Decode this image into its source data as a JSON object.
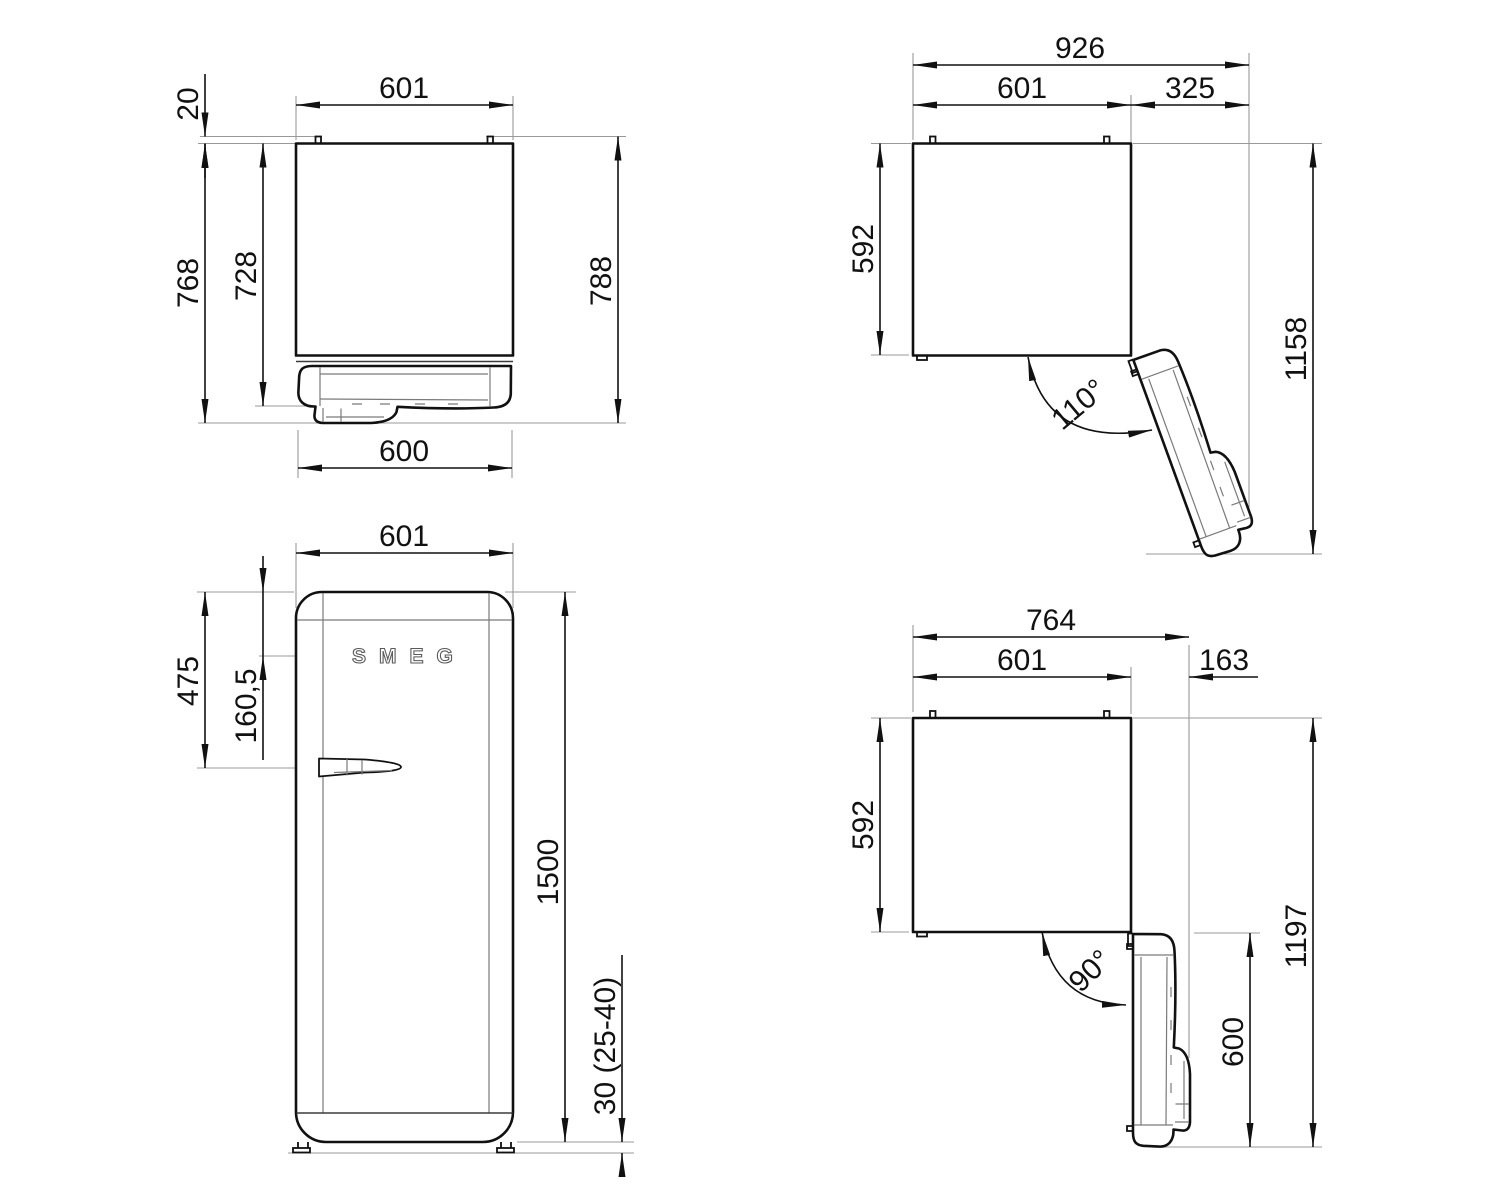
{
  "drawing": {
    "type": "appliance-installation-dimension-drawing",
    "units_note": "mm",
    "colors": {
      "line": "#111111",
      "detail": "#7a7a7a",
      "extension": "#999999",
      "background": "#ffffff"
    },
    "views": {
      "plan_closed": {
        "body_width": "601",
        "hinge_pin_offset": "20",
        "depth_with_door": "728",
        "depth_with_handle": "768",
        "depth_total": "788",
        "door_width": "600"
      },
      "plan_open_110": {
        "overall_width": "926",
        "body_width": "601",
        "door_clearance": "325",
        "body_depth": "592",
        "depth_door_open": "1158",
        "opening_angle": "110°"
      },
      "front": {
        "body_width": "601",
        "handle_offset_top": "475",
        "logo_offset_top": "160,5",
        "height": "1500",
        "feet_height": "30 (25-40)",
        "logo": "SMEG"
      },
      "plan_open_90": {
        "overall_width": "764",
        "body_width": "601",
        "door_clearance": "163",
        "body_depth": "592",
        "depth_door_open": "1197",
        "door_width": "600",
        "opening_angle": "90°"
      }
    }
  }
}
